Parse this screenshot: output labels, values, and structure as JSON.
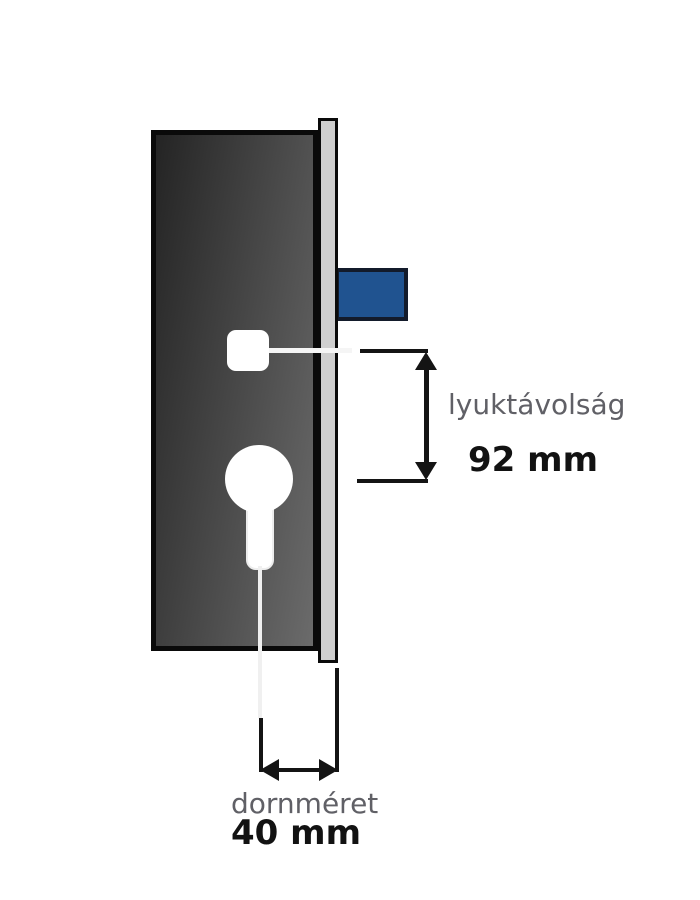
{
  "title": "mortise-lock-dimension-diagram",
  "colors": {
    "body_dark": "#242424",
    "body_light": "#6b6b6b",
    "faceplate_gray": "#cfcfcf",
    "outline_black": "#0a0a0a",
    "latch_blue": "#205390",
    "latch_border": "#131b2b",
    "dim_black": "#141414",
    "label_gray": "#606066",
    "value_black": "#121212"
  },
  "parts": {
    "lock_body": "lock-case",
    "faceplate": "faceplate-strip",
    "latch": "latch-bolt",
    "spindle_hole": "spindle-square-hole",
    "cylinder_hole": "euro-cylinder-keyhole"
  },
  "dimensions": [
    {
      "label": "lyuktávolság",
      "value": "92 mm"
    },
    {
      "label": "dornméret",
      "value": "40 mm"
    }
  ]
}
